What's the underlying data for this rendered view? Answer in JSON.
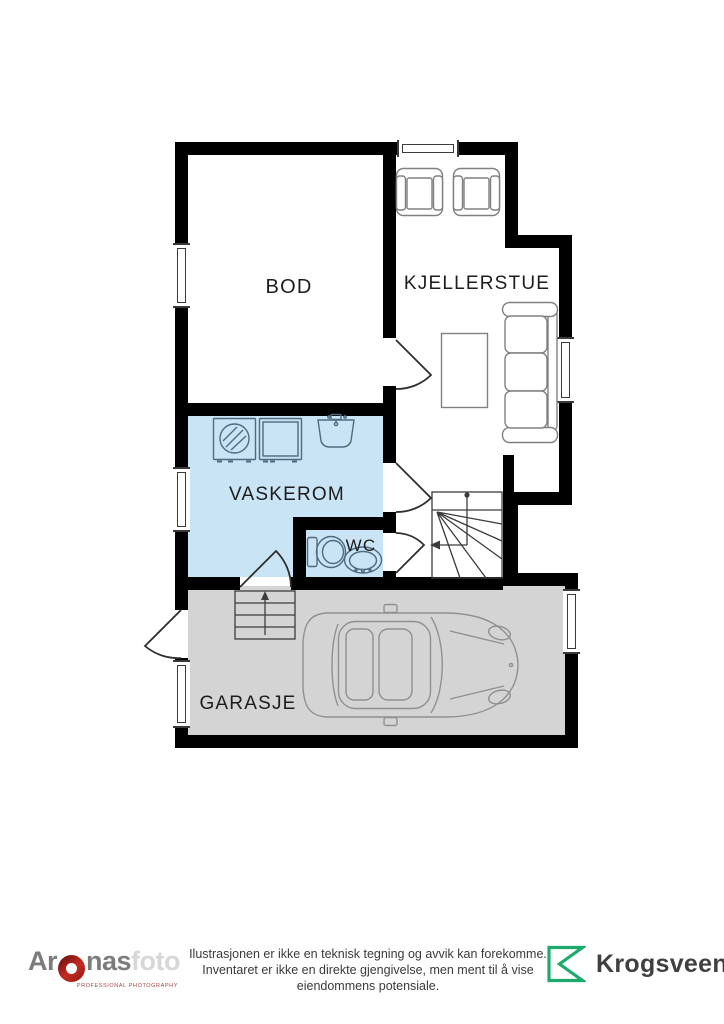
{
  "plan": {
    "rooms": {
      "bod": {
        "label": "BOD"
      },
      "kjellerstue": {
        "label": "KJELLERSTUE"
      },
      "vaskerom": {
        "label": "VASKEROM"
      },
      "wc": {
        "label": "WC"
      },
      "garasje": {
        "label": "GARASJE"
      }
    },
    "colors": {
      "wall": "#000000",
      "wet_room_fill": "#c9e4f4",
      "garage_fill": "#d4d4d4",
      "fixture_outline": "#4f6b7d",
      "furniture_outline": "#808080",
      "stairs_outline": "#3c3c3c",
      "car_outline": "#909090",
      "label_text": "#1d1d1d"
    },
    "icons": {
      "fixtures": [
        "washing-machine-icon",
        "appliance-icon",
        "laundry-sink-icon",
        "toilet-icon",
        "wc-sink-icon"
      ],
      "furniture": [
        "armchair-icon",
        "sofa-icon",
        "coffee-table-icon",
        "car-icon"
      ],
      "symbols": [
        "window-symbol",
        "door-swing-icon",
        "stairs-icon",
        "garage-steps-icon"
      ]
    }
  },
  "footer": {
    "disclaimer": {
      "line1": "Ilustrasjonen er ikke en teknisk tegning og avvik kan forekomme.",
      "line2": "Inventaret er ikke en direkte gjengivelse, men ment til å vise",
      "line3": "eiendommens potensiale."
    },
    "aronas": {
      "part1": "Ar",
      "part2": "nas",
      "part3": "foto",
      "tagline": "PROFESSIONAL PHOTOGRAPHY",
      "red": "#9e1b15",
      "gray": "#7c7c7c",
      "light": "#d7d7d7"
    },
    "krogsveen": {
      "name": "Krogsveen",
      "green": "#1ea96d",
      "text_color": "#404040"
    }
  }
}
